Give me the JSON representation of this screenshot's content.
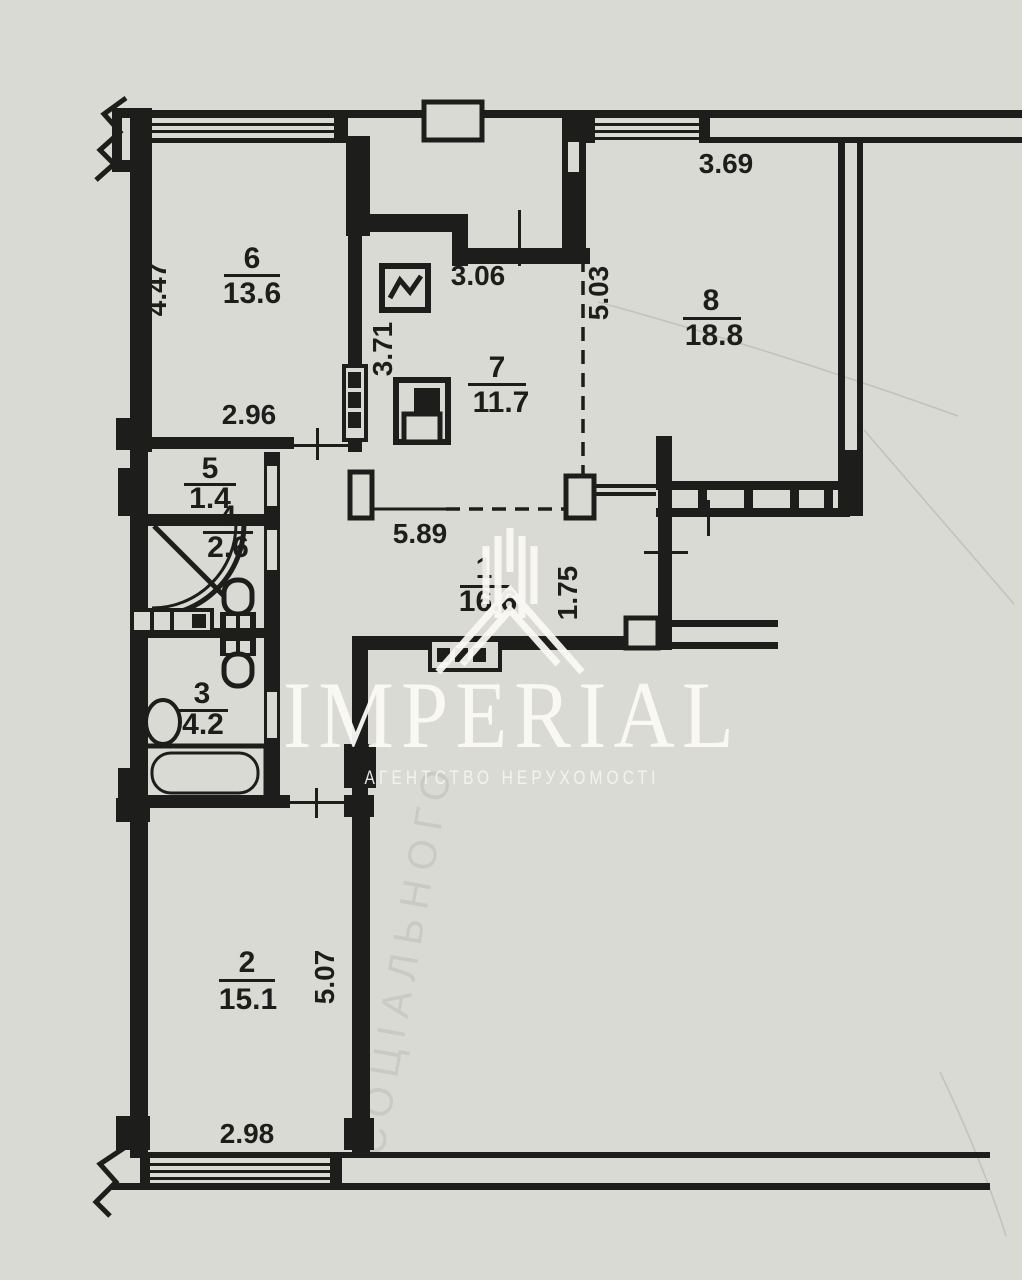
{
  "meta": {
    "paper_color": "#dadad5",
    "ink_color": "#1d1d1b",
    "watermark_color": "#fbfaf7"
  },
  "watermark": {
    "brand": "IMPERIAL",
    "tagline": "АГЕНТСТВО НЕРУХОМОСТІ",
    "logo": "roof-monogram",
    "faint_stamp": "СОЦІАЛЬНОГО"
  },
  "rooms": [
    {
      "id": "room-6",
      "number": "6",
      "area": "13.6"
    },
    {
      "id": "room-7",
      "number": "7",
      "area": "11.7"
    },
    {
      "id": "room-8",
      "number": "8",
      "area": "18.8"
    },
    {
      "id": "room-5",
      "number": "5",
      "area": "1.4"
    },
    {
      "id": "room-4",
      "number": "4",
      "area": "2.6"
    },
    {
      "id": "room-3",
      "number": "3",
      "area": "4.2"
    },
    {
      "id": "room-1",
      "number": "1",
      "area": "16.6"
    },
    {
      "id": "room-2",
      "number": "2",
      "area": "15.1"
    }
  ],
  "dimensions": {
    "room6_height": "4.47",
    "room6_width": "2.96",
    "room7_top": "3.06",
    "room7_left": "3.71",
    "room7_bottom": "5.89",
    "room8_left": "5.03",
    "room8_top": "3.69",
    "hall_width": "1.75",
    "room2_height": "5.07",
    "room2_width": "2.98"
  },
  "fixtures": [
    "corner-shower",
    "toilet",
    "toilet",
    "washbasin",
    "sink-counter",
    "bathtub",
    "electric-panel",
    "stove",
    "vent-shaft",
    "vent-box"
  ]
}
